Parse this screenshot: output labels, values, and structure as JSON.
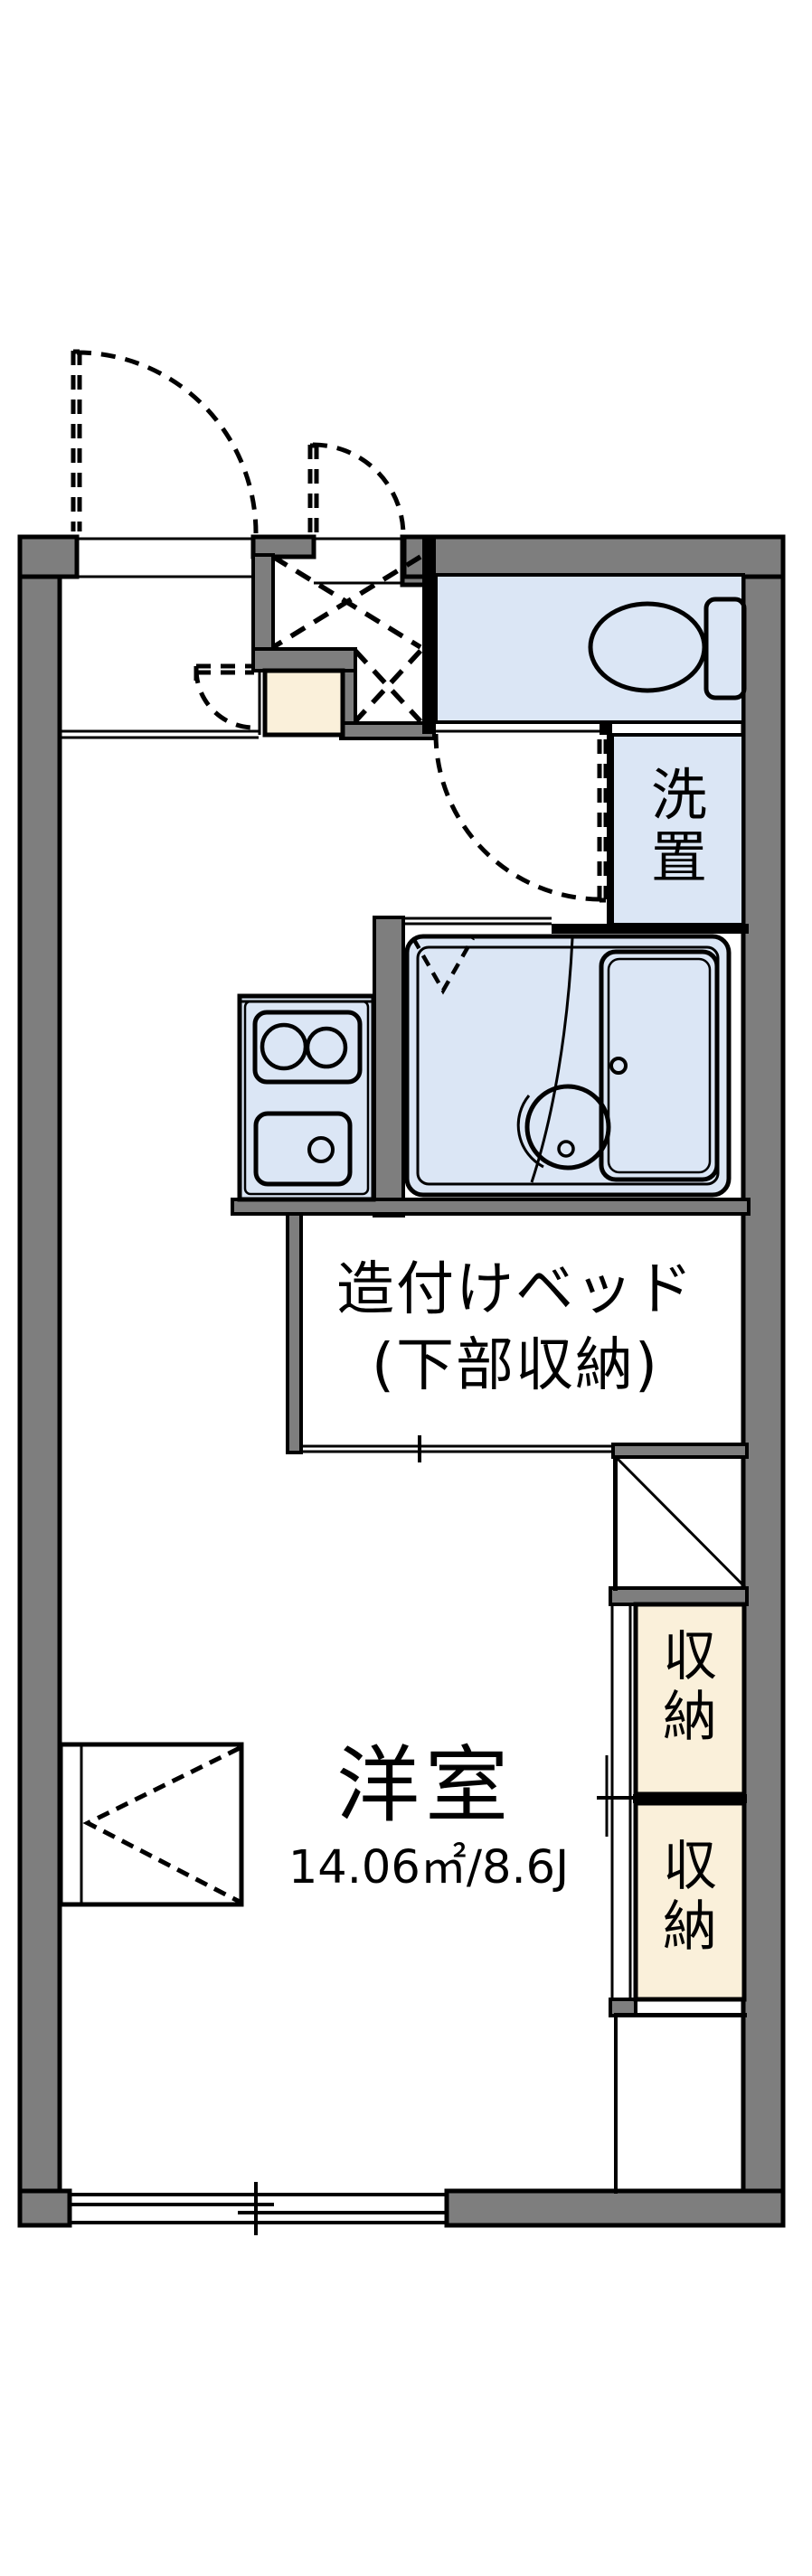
{
  "floor_plan": {
    "labels": {
      "bed_line1": "造付けベッド",
      "bed_line2": "(下部収納)",
      "room_name": "洋室",
      "room_size": "14.06㎡/8.6J",
      "washer": "洗置",
      "storage_upper": "収納",
      "storage_lower": "収納"
    },
    "colors": {
      "wall_gray": "#7e7e7e",
      "room_blue": "#dbe6f5",
      "closet_cream": "#faf0da",
      "line_black": "#000000",
      "background": "#ffffff"
    },
    "icons": [
      "toilet-icon",
      "bathtub-icon",
      "washbasin-icon",
      "stove-burners-icon",
      "kitchen-sink-icon",
      "door-swing-arc-icon",
      "sliding-window-icon",
      "folding-door-icon",
      "entrance-cross-icon",
      "refrigerator-space-diagonal-icon"
    ]
  }
}
